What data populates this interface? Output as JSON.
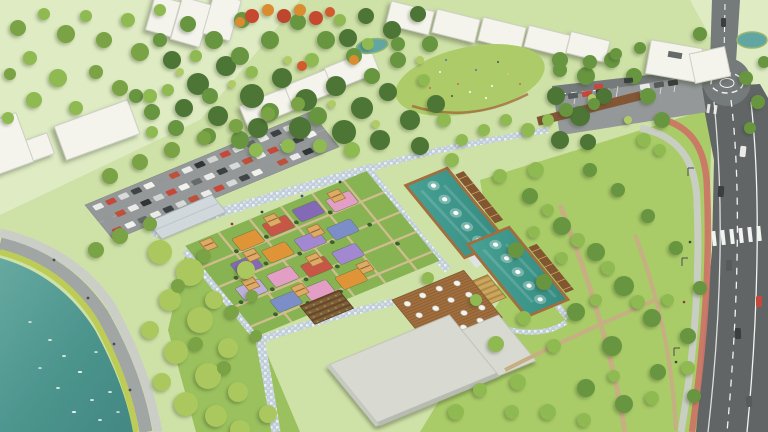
{
  "meta": {
    "title": "Urban park masterplan aerial render",
    "description": "Aerial 3D architectural rendering of a landscaped urban park: colorful flower parterres with wooden pavilions, two rectangular fountain pools with pergolas, a lakeside curved promenade, tree-lined parking lots, cafe terrace building, forest belt with residential blocks, and an arterial road with a roundabout and red cycle track.",
    "view": "bird's-eye axonometric",
    "visible_text": ""
  },
  "counts": {
    "fountain_pools": 2,
    "fountain_jets_per_pool": 5,
    "garden_pavilions": 9,
    "flower_parterres": 15,
    "cafe_tables": 15,
    "parking_rows": 3,
    "roundabouts": 1
  },
  "parking": {
    "rows": 3,
    "cars_per_row": 17,
    "colors": [
      "#e9eaea",
      "#c23b2f",
      "#d6d8d9",
      "#32373c",
      "#f1f1ef",
      "#8b9094",
      "#b8442f",
      "#e9eaea",
      "#22262a",
      "#cfd1d2",
      "#c23b2f",
      "#f1f1ef",
      "#5a6066",
      "#e9eaea",
      "#2e3338",
      "#d6d8d9",
      "#b8442f"
    ]
  },
  "palette": {
    "base_lawn": "#cbdfa4",
    "pale_field": "#dceac2",
    "right_lawn": "#a3c860",
    "central_lawn": "#93bd54",
    "forest_dark": "#3f6b2a",
    "forest_mid": "#5d8f35",
    "tree_light": "#86b548",
    "tree_lush": "#a4c455",
    "tree_accent": "#6f9c3a",
    "tree_yellow": "#aac85e",
    "autumn_red": "#c23b22",
    "autumn_orange": "#d98324",
    "cypress": "#2c5522",
    "water_lake": "#4a948e",
    "water_pool": "#2e8c84",
    "pond_teal": "#57a0a0",
    "road_asphalt": "#6b7074",
    "road_dark": "#565a5e",
    "marking_white": "#f2f4f4",
    "bike_red": "#c96a5e",
    "sidewalk": "#c6cbc5",
    "promenade_gray": "#9aa0a2",
    "verge_yellow": "#b8c94e",
    "parking_asphalt": "#8d9194",
    "building_white": "#f4f4ef",
    "building_shadow": "#c9cbc4",
    "roof_gray": "#d5d8d2",
    "canopy_gray": "#cdd6dd",
    "mosaic_blue": "#bccadb",
    "wood_deck": "#9a6433",
    "pergola_brown": "#7a4a26",
    "pavilion_tan": "#dca55e",
    "flower_orange": "#dd8c2c",
    "flower_purple": "#7b5fb4",
    "flower_violet": "#9a7fd0",
    "flower_pink": "#e197c4",
    "flower_red": "#c34a3c",
    "flower_blue": "#7186c8",
    "flower_lavender": "#b9a8dd",
    "crop_gold": "#c8a055",
    "crop_brown": "#7a5230",
    "path_dirt": "#c2a97c",
    "car_dark": "#2c3034",
    "car_gray": "#4a4f54",
    "car_white": "#e9eaea",
    "car_red": "#c23b2f"
  },
  "regions": [
    {
      "name": "lake-promenade",
      "label": "teal lake with curved promenade and birds"
    },
    {
      "name": "entrance-parking",
      "label": "tree-lined parking lot full of cars"
    },
    {
      "name": "flower-garden",
      "label": "grid of colorful flower parterres with pavilions and cypresses"
    },
    {
      "name": "fountain-pools",
      "label": "two rectangular teal pools with fountain jets and pergolas"
    },
    {
      "name": "cafe-terrace",
      "label": "wooden deck with round white tables beside flat-roofed building"
    },
    {
      "name": "crop-beds",
      "label": "community crop beds"
    },
    {
      "name": "forest-belt",
      "label": "dense tree belt with great lawn meadow and ponds"
    },
    {
      "name": "residential-blocks",
      "label": "white low-rise building slabs"
    },
    {
      "name": "arterial-road",
      "label": "multi-lane road with roundabout, crosswalk and red cycle track"
    }
  ]
}
